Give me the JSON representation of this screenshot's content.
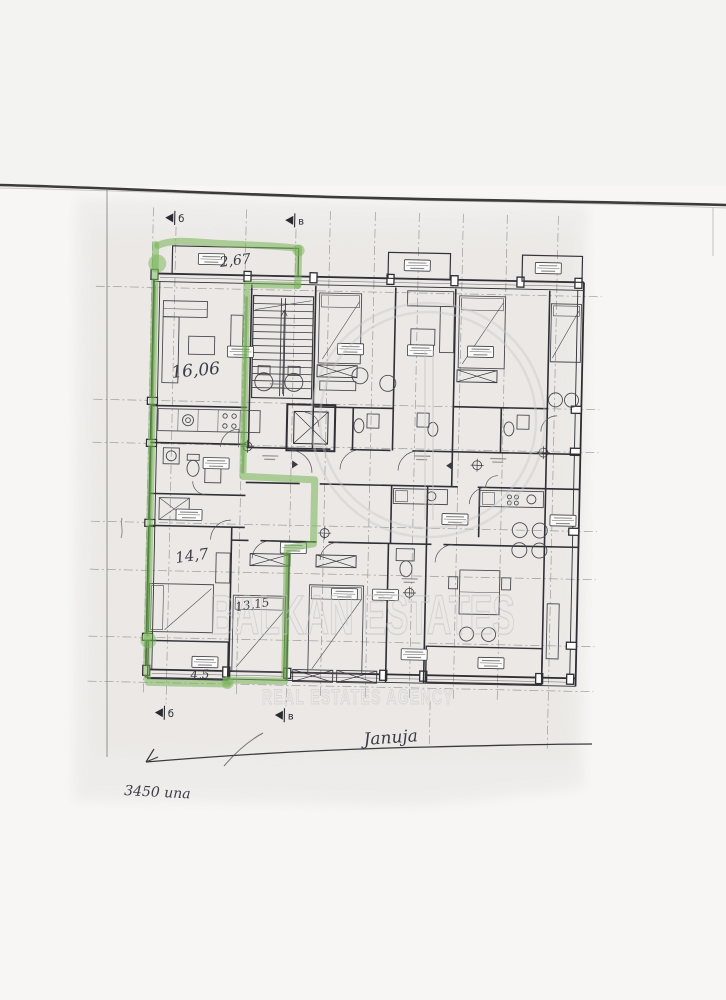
{
  "scan": {
    "background_color": "#f7f6f5",
    "paper_tint_color": "#e8e5e2",
    "ink_color": "#33333a"
  },
  "watermark": {
    "title": "BALKAN ESTATES",
    "subtitle": "REAL ESTATES AGENCY",
    "color": "#c2c2c2"
  },
  "highlight_color": "#76b356",
  "floor_plan": {
    "section_markers": {
      "left": "б",
      "right": "в"
    },
    "area_labels": {
      "top_balcony": "2,67",
      "living_room": "16,06",
      "bedroom_left": "14,7",
      "bedroom_middle": "13,15",
      "bottom_balcony": "4,5"
    }
  },
  "handwritten_notes": {
    "middle": "Januja",
    "bottom_left": "3450 una"
  }
}
